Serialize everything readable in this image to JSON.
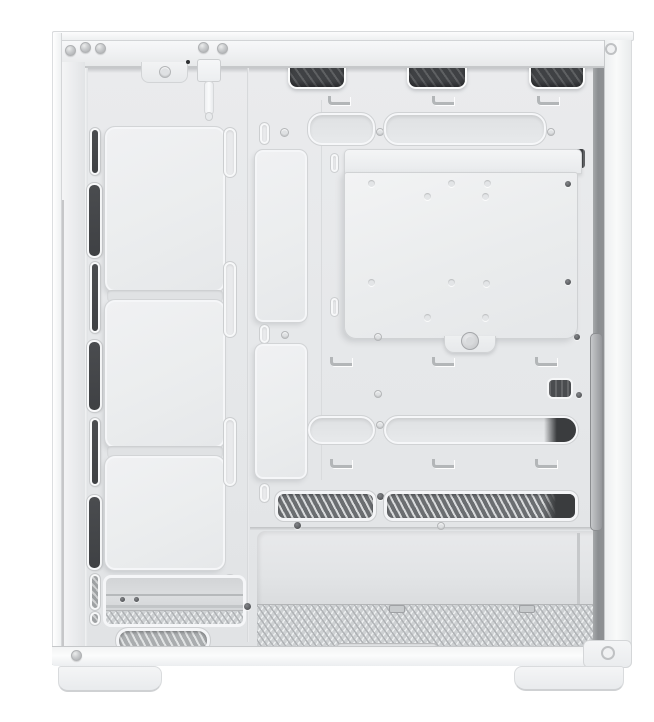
{
  "meta": {
    "domain": "Natural-Image",
    "description": "Product photo of a white mid-tower PC case with the side panel removed, interior view: front fan bracket with dark vent slots, motherboard tray with cable-routing channels and removable bracket plate secured by a thumbscrew, top mesh exhaust vents, open PSU chamber with perforated floor dust filter, bottom frame with two white feet.",
    "background": "#ffffff"
  },
  "palette": {
    "bg": "#ffffff",
    "case_white": "#f5f6f7",
    "interior": "#e8e9eb",
    "plate": "#eef0f1",
    "rim": "#f8f9fa",
    "line": "#cfd1d3",
    "dark": "#3f4144",
    "mesh": "#6b6e71",
    "gap": "#8b8e91",
    "screw": "#55575a"
  },
  "parts": {
    "top_rail": {
      "rivet_count": 5,
      "front_io_cable": 1
    },
    "top_vents": {
      "count": 3,
      "texture": "diagonal-mesh"
    },
    "cable_tie_hooks": {
      "rows": 3,
      "per_row": 3
    },
    "front_fan_bracket": {
      "fan_plates": 3,
      "left_vent_slots": 8,
      "right_oval_slots": 4
    },
    "center_bracket_plate": {
      "screw_holes": 10,
      "dark_screws": 2,
      "thumbscrews": 1
    },
    "routing_cutouts": {
      "top_row": 2,
      "middle_row": 2,
      "mesh_row": 2,
      "small_dark_cutouts": 3
    },
    "psu_chamber": {
      "floor": "perforated",
      "filter_slot": 1
    },
    "feet": {
      "count": 2
    }
  }
}
